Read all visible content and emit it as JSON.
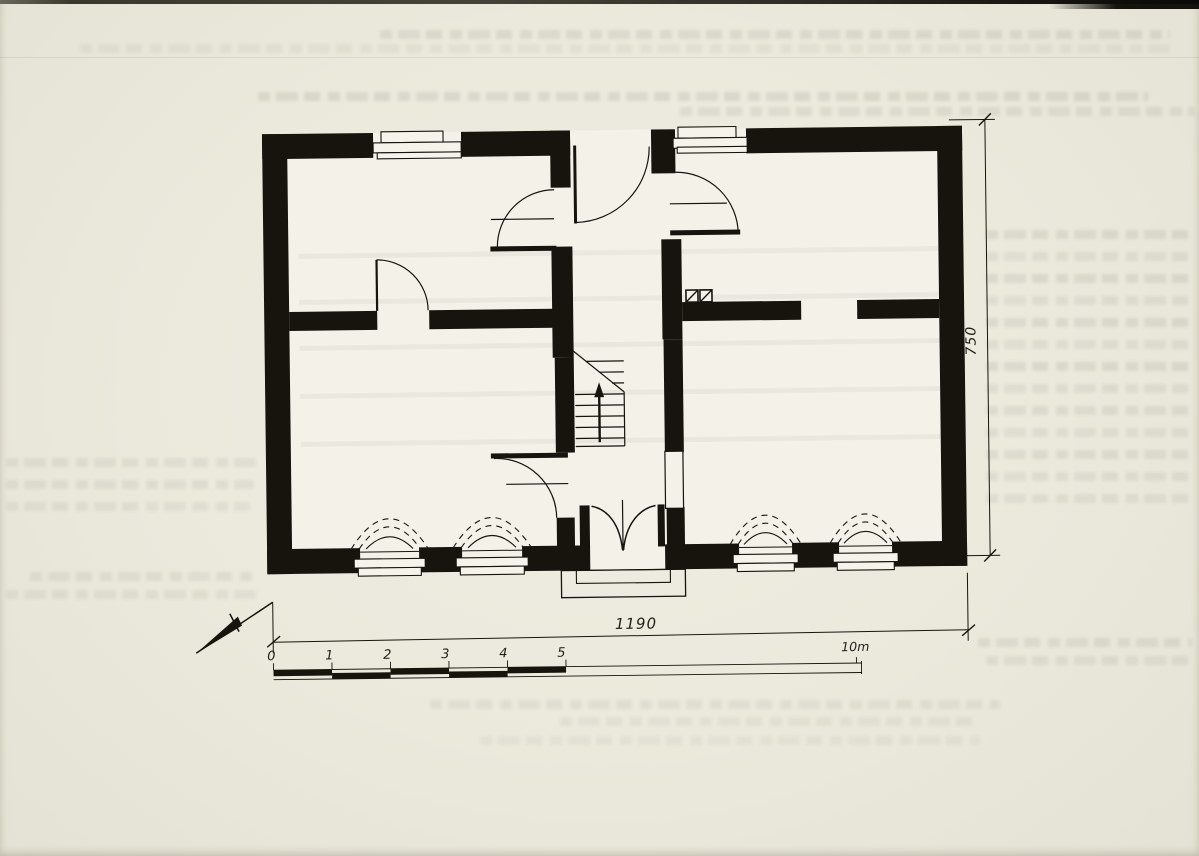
{
  "document": {
    "kind": "scanned architectural floor plan",
    "paper_color": "#ebe9dc",
    "ink_color": "#17140e"
  },
  "floor_plan": {
    "width_dimension_label": "1190",
    "height_dimension_label": "750",
    "scale_bar": {
      "tick_labels": [
        "0",
        "1",
        "2",
        "3",
        "4",
        "5"
      ],
      "end_label": "10m"
    },
    "symbols": {
      "north_arrow": "north-arrow",
      "staircase": "stair-run-with-up-arrow",
      "entrance_door": "double-swing-door",
      "chimney": "chimney-flue-squares",
      "windows_bottom": 4,
      "windows_top": 2
    }
  }
}
